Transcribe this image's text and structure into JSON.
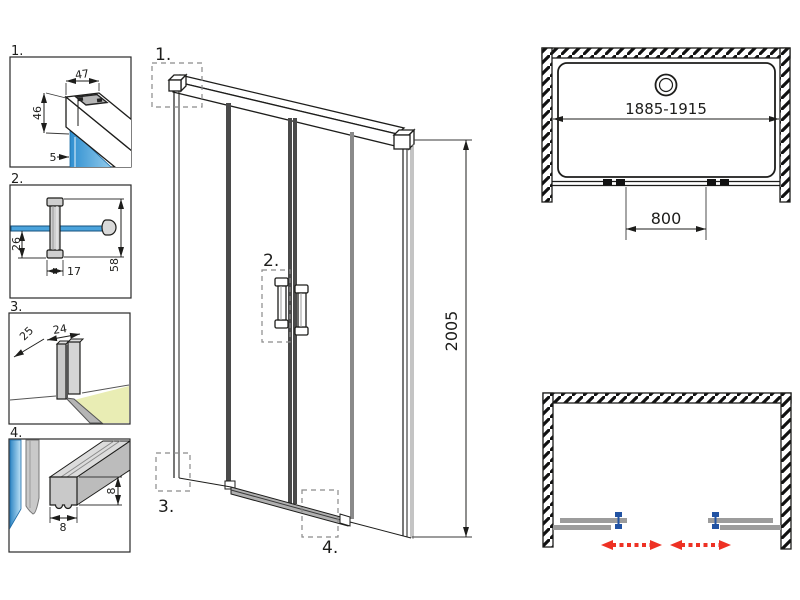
{
  "colors": {
    "line": "#1d1d1b",
    "glass_blue": "#3f9cd6",
    "glass_blue_light": "#bfe3f7",
    "profile_gray": "#c9c9c9",
    "floor_yellow": "#e9edb4",
    "slider_gray": "#9c9c9c",
    "roller_blue": "#2253a3",
    "arrow_red": "#ee3124"
  },
  "details": [
    {
      "label": "1.",
      "dims": {
        "profile_width": "47",
        "profile_height": "46",
        "glass_thickness": "5"
      }
    },
    {
      "label": "2.",
      "dims": {
        "handle_offset": "26",
        "handle_width": "17",
        "handle_length": "58"
      }
    },
    {
      "label": "3.",
      "dims": {
        "guide_depth": "25",
        "guide_width": "24"
      }
    },
    {
      "label": "4.",
      "dims": {
        "seal_height": "8",
        "seal_width": "8"
      }
    }
  ],
  "front_view": {
    "callouts": [
      {
        "label": "1."
      },
      {
        "label": "2."
      },
      {
        "label": "3."
      },
      {
        "label": "4."
      }
    ],
    "height_dim": "2005"
  },
  "plan_view": {
    "width_dim": "1885-1915",
    "opening_dim": "800"
  }
}
